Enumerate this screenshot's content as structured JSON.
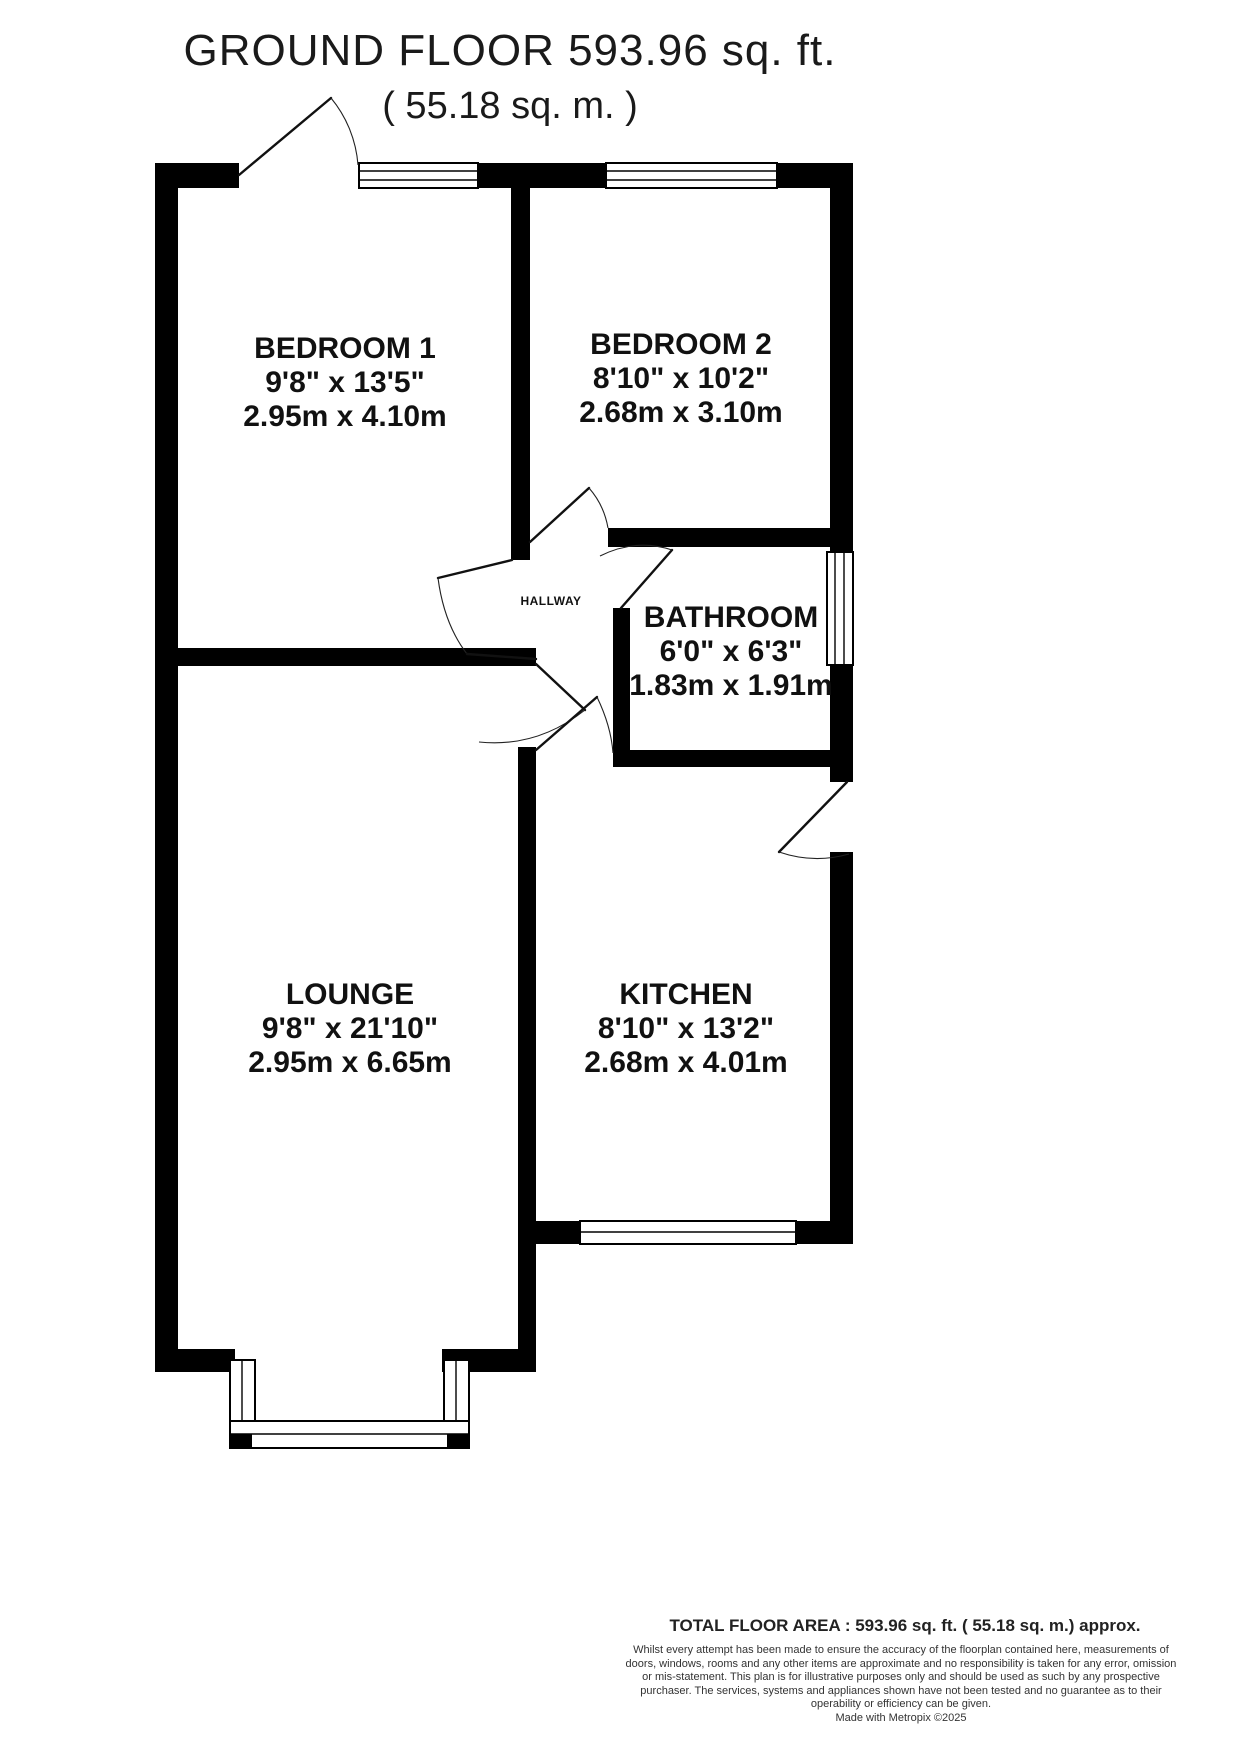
{
  "header": {
    "title": "GROUND FLOOR 593.96 sq. ft.",
    "subtitle": "( 55.18 sq. m. )"
  },
  "rooms": {
    "bedroom1": {
      "name": "BEDROOM 1",
      "imperial": "9'8\" x 13'5\"",
      "metric": "2.95m x 4.10m"
    },
    "bedroom2": {
      "name": "BEDROOM 2",
      "imperial": "8'10\" x 10'2\"",
      "metric": "2.68m x 3.10m"
    },
    "bathroom": {
      "name": "BATHROOM",
      "imperial": "6'0\" x 6'3\"",
      "metric": "1.83m x 1.91m"
    },
    "lounge": {
      "name": "LOUNGE",
      "imperial": "9'8\" x 21'10\"",
      "metric": "2.95m x 6.65m"
    },
    "kitchen": {
      "name": "KITCHEN",
      "imperial": "8'10\" x 13'2\"",
      "metric": "2.68m x 4.01m"
    },
    "hallway": {
      "name": "HALLWAY"
    }
  },
  "footer": {
    "total": "TOTAL FLOOR AREA : 593.96 sq. ft. ( 55.18 sq. m.) approx.",
    "disclaimer": "Whilst every attempt has been made to ensure the accuracy of the floorplan contained here, measurements of doors, windows, rooms and any other items are approximate and no responsibility is taken for any error, omission or mis-statement. This plan is for illustrative purposes only and should be used as such by any prospective purchaser. The services, systems and appliances shown have not been tested and no guarantee as to their operability or efficiency can be given.",
    "credit": "Made with Metropix ©2025"
  },
  "colors": {
    "wall": "#000000",
    "text": "#1a1a1a",
    "muted": "#333333"
  }
}
